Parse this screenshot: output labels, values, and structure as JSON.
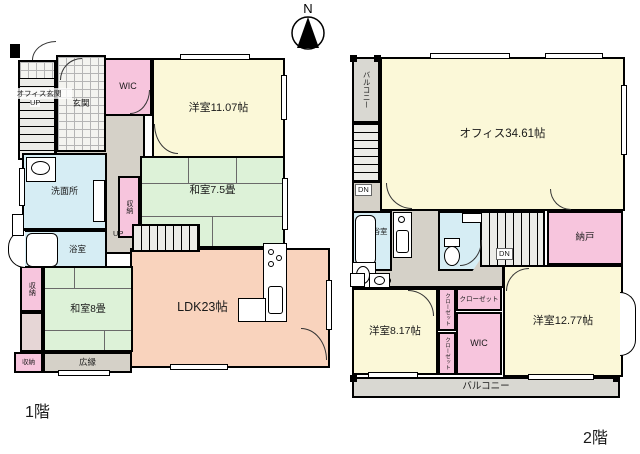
{
  "compass": {
    "label": "N"
  },
  "floor1": {
    "label": "1階",
    "office_entrance": "オフィス玄関",
    "office_entrance_up": "UP",
    "genkan": "玄関",
    "wic": "WIC",
    "bedroom_1107": "洋室11.07帖",
    "tatami_75": "和室7.5畳",
    "storage_mid": "収納",
    "stairs_up": "UP",
    "washroom": "洗面所",
    "bath": "浴室",
    "storage_left": "収納",
    "tatami_8": "和室8畳",
    "storage_bottom": "収納",
    "hiroen": "広縁",
    "ldk": "LDK23帖"
  },
  "floor2": {
    "label": "2階",
    "balcony_side": "バルコニー",
    "stairs_dn_top": "DN",
    "office": "オフィス34.61帖",
    "bath": "浴室",
    "stairs_dn_mid": "DN",
    "storage_room": "納戸",
    "bedroom_817": "洋室8.17帖",
    "closet_v1": "クローゼット",
    "closet_v2": "クローゼット",
    "closet_h": "クローゼット",
    "wic": "WIC",
    "bedroom_1277": "洋室12.77帖",
    "balcony_bottom": "バルコニー"
  },
  "colors": {
    "room_cream": "#fbf8d8",
    "room_pink": "#f7c5dd",
    "room_green": "#ddf2d8",
    "room_blue": "#d6edf4",
    "room_peach": "#f9d3bd",
    "hall_gray": "#d5d1c8",
    "balcony_gray": "#d9d8d2",
    "storage_dim": "#e6d6d6",
    "wall": "#000000"
  }
}
